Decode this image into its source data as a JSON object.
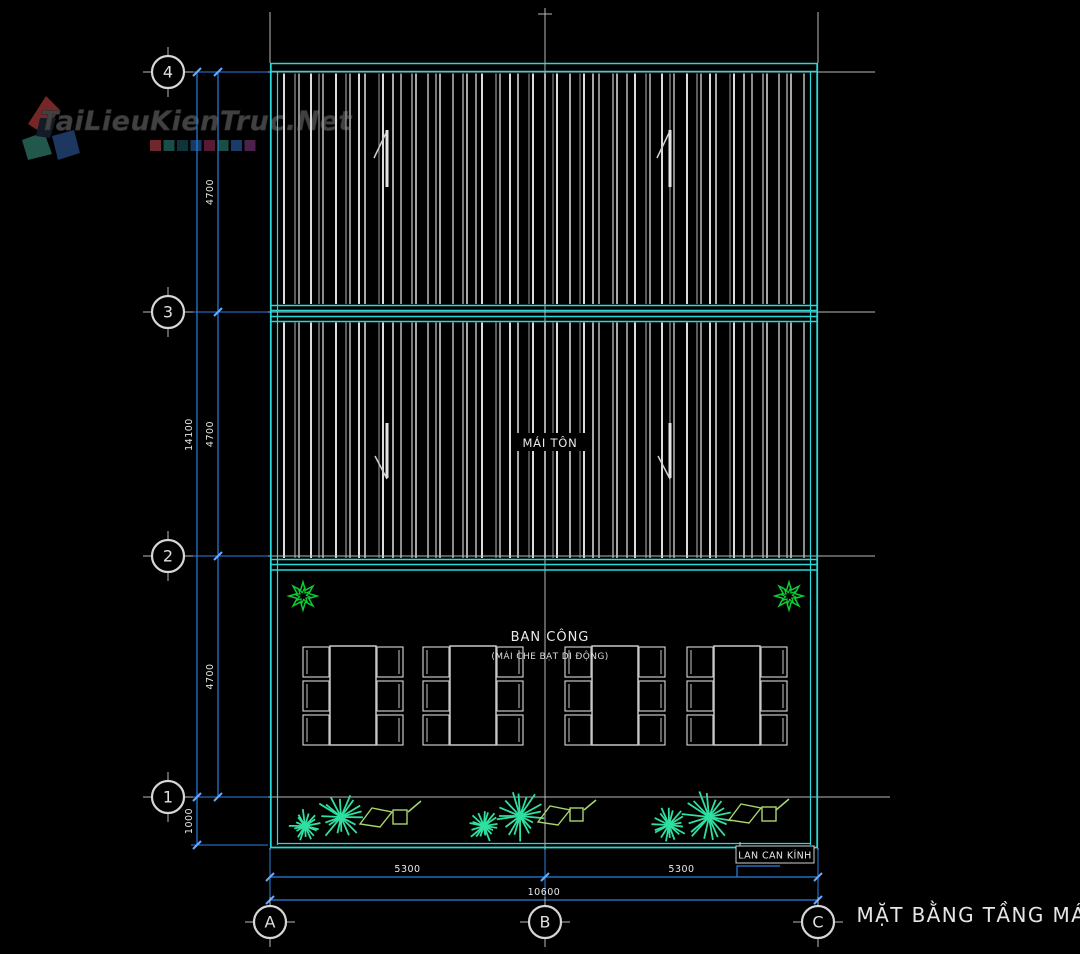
{
  "watermark": {
    "text": "TaiLieuKienTruc.Net",
    "squares": [
      "#8b3038",
      "#1f6059",
      "#123f46",
      "#1f4a7e",
      "#6d2140",
      "#1f6059",
      "#204a7e",
      "#5c2a5e"
    ]
  },
  "drawing_title": "MẶT BẰNG TẦNG MÁI",
  "labels": {
    "roof": "MÁI TÔN",
    "balcony": "BAN CÔNG",
    "balcony_note": "(MÁI CHE BẠT DI ĐỘNG)",
    "railing": "LAN CAN KÍNH"
  },
  "grid": {
    "rows": [
      {
        "label": "4",
        "y": 72
      },
      {
        "label": "3",
        "y": 312
      },
      {
        "label": "2",
        "y": 556
      },
      {
        "label": "1",
        "y": 797
      }
    ],
    "cols": [
      {
        "label": "A",
        "x": 270
      },
      {
        "label": "B",
        "x": 545
      },
      {
        "label": "C",
        "x": 818
      }
    ]
  },
  "dims": {
    "left_segments": [
      {
        "value": "4700",
        "y1": 72,
        "y2": 312
      },
      {
        "value": "4700",
        "y1": 312,
        "y2": 556
      },
      {
        "value": "4700",
        "y1": 556,
        "y2": 797
      }
    ],
    "left_total": {
      "value": "14100",
      "y1": 72,
      "y2": 797
    },
    "left_parapet": {
      "value": "1000",
      "y1": 797,
      "y2": 845
    },
    "bottom_segments": [
      {
        "value": "5300",
        "x1": 270,
        "x2": 545
      },
      {
        "value": "5300",
        "x1": 545,
        "x2": 818
      }
    ],
    "bottom_total": {
      "value": "10600",
      "x1": 270,
      "x2": 818
    }
  },
  "colors": {
    "background": "#000000",
    "outline_cyan": "#2bd8d8",
    "dim_blue": "#2b7fe0",
    "dim_tick": "#66aaff",
    "grid_line": "#b9b9b9",
    "hatch_bright": "#dcdcdc",
    "hatch_mid": "#a8a8a8",
    "hatch_dim": "#8c8c8c",
    "text": "#e9e9e9",
    "flower_green": "#0ccd35",
    "palm_teal": "#2fe0a0",
    "symbol_green": "#a8d66b",
    "watermark_text": "#454545"
  }
}
